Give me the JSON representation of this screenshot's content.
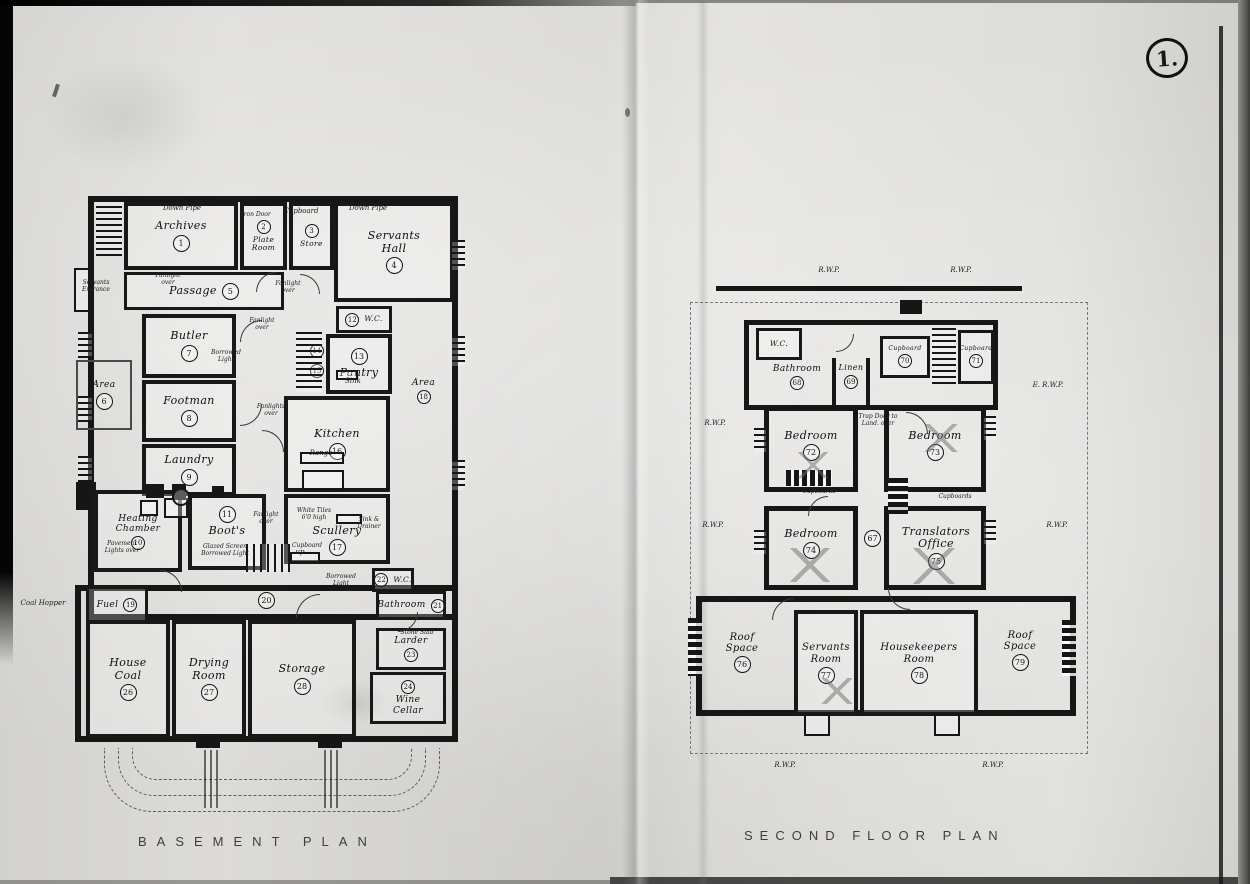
{
  "page": {
    "stamp": "1.",
    "basement_title": "BASEMENT PLAN",
    "second_title": "SECOND FLOOR PLAN"
  },
  "basement": {
    "rooms": {
      "archives": {
        "label": "Archives",
        "num": "1"
      },
      "plate_room": {
        "label": "Plate Room",
        "num": "2"
      },
      "store": {
        "label": "Store",
        "num": "3"
      },
      "servants_hall": {
        "label": "Servants Hall",
        "num": "4"
      },
      "passage": {
        "label": "Passage",
        "num": "5"
      },
      "area_w": {
        "label": "Area",
        "num": "6"
      },
      "butler": {
        "label": "Butler",
        "num": "7"
      },
      "footman": {
        "label": "Footman",
        "num": "8"
      },
      "laundry": {
        "label": "Laundry",
        "num": "9"
      },
      "heating_chamber": {
        "label": "Heating Chamber",
        "num": "10"
      },
      "boots": {
        "label": "Boot's",
        "num": "11"
      },
      "wc12": {
        "label": "W.C.",
        "num": "12"
      },
      "pantry": {
        "label": "Pantry",
        "num": "13"
      },
      "stair14": {
        "num": "14"
      },
      "stair15": {
        "num": "15"
      },
      "kitchen": {
        "label": "Kitchen",
        "num": "16"
      },
      "scullery": {
        "label": "Scullery",
        "num": "17"
      },
      "area_e": {
        "label": "Area",
        "num": "18"
      },
      "fuel": {
        "label": "Fuel",
        "num": "19"
      },
      "corridor": {
        "num": "20"
      },
      "bathroom": {
        "label": "Bathroom",
        "num": "21"
      },
      "wc22": {
        "label": "W.C.",
        "num": "22"
      },
      "larder": {
        "label": "Larder",
        "num": "23"
      },
      "wine_cellar": {
        "label": "Wine Cellar",
        "num": "24"
      },
      "house_coal": {
        "label": "House Coal",
        "num": "26"
      },
      "drying_room": {
        "label": "Drying Room",
        "num": "27"
      },
      "storage": {
        "label": "Storage",
        "num": "28"
      }
    },
    "notes": {
      "down_pipe_l": "Down Pipe",
      "iron_door": "Iron Door",
      "cupboard_top": "Cupboard",
      "down_pipe_r": "Down Pipe",
      "servants_entrance": "Servants Entrance",
      "fanlight_1": "Fanlight over",
      "fanlight_2": "Fanlight over",
      "fanlight_3": "Fanlight over",
      "fanlight_4": "Fanlights over",
      "fanlight_5": "Fanlight over",
      "borrowed_light_1": "Borrowed Light",
      "borrowed_light_2": "Borrowed Light",
      "pavement_lights": "Pavement Lights over",
      "glazed_screen": "Glazed Screen Borrowed Light",
      "range": "Range",
      "sink": "Sink",
      "sink_drainer": "Sink & Drainer",
      "white_tiles": "White Tiles 6'0 high",
      "cupboard_scullery": "Cupboard",
      "coal_hopper": "Coal Hopper",
      "stone_slab": "Stone Slab",
      "up": "up"
    }
  },
  "second_floor": {
    "rooms": {
      "wc": {
        "label": "W.C."
      },
      "bathroom": {
        "label": "Bathroom",
        "num": "68"
      },
      "linen": {
        "label": "Linen",
        "num": "69"
      },
      "cupboard70": {
        "label": "Cupboard",
        "num": "70"
      },
      "cupboard71": {
        "label": "Cupboard",
        "num": "71"
      },
      "bedroom72": {
        "label": "Bedroom",
        "num": "72"
      },
      "bedroom73": {
        "label": "Bedroom",
        "num": "73"
      },
      "bedroom74": {
        "label": "Bedroom",
        "num": "74"
      },
      "landing": {
        "num": "67"
      },
      "translators_office": {
        "label": "Translators Office",
        "num": "75"
      },
      "roof_space_w": {
        "label": "Roof Space",
        "num": "76"
      },
      "servants_room": {
        "label": "Servants Room",
        "num": "77"
      },
      "housekeepers_room": {
        "label": "Housekeepers Room",
        "num": "78"
      },
      "roof_space_e": {
        "label": "Roof Space",
        "num": "79"
      }
    },
    "notes": {
      "rwp_top_l": "R.W.P.",
      "rwp_top_r": "R.W.P.",
      "rwp_left": "R.W.P.",
      "rwp_left2": "R.W.P.",
      "erwp_right": "E. R.W.P.",
      "rwp_right": "R.W.P.",
      "rwp_bot_l": "R.W.P.",
      "rwp_bot_r": "R.W.P.",
      "trap_door": "Trap Door to Land. over",
      "cupboards_l": "Cupboards",
      "cupboards_r": "Cupboards"
    }
  }
}
